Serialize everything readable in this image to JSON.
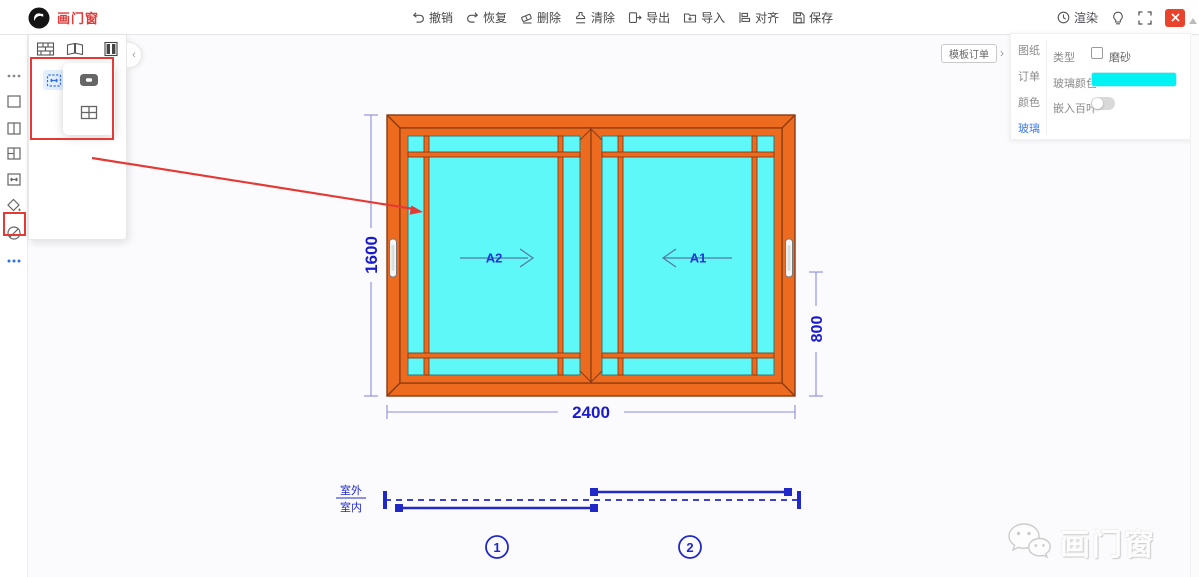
{
  "app": {
    "name": "画门窗",
    "brand_color": "#e03a3a"
  },
  "topbar": {
    "actions": [
      {
        "name": "undo",
        "label": "撤销"
      },
      {
        "name": "redo",
        "label": "恢复"
      },
      {
        "name": "delete",
        "label": "删除"
      },
      {
        "name": "clear",
        "label": "清除"
      },
      {
        "name": "export",
        "label": "导出"
      },
      {
        "name": "import",
        "label": "导入"
      },
      {
        "name": "align",
        "label": "对齐"
      },
      {
        "name": "save",
        "label": "保存"
      }
    ],
    "render_label": "渲染",
    "right_icons": [
      "render-clock-icon",
      "bulb-icon",
      "fullscreen-icon",
      "close-button"
    ]
  },
  "left_toolbar": {
    "icons": [
      "more-tools",
      "rect-window",
      "two-pane-window",
      "split-pane-window",
      "sliding-window-tool",
      "fill-color",
      "disabled-tool",
      "more-options"
    ]
  },
  "flyout": {
    "top_icons": [
      "wall-grid-icon",
      "open-window-icon",
      "filled-window-icon"
    ],
    "collapse_glyph": "‹",
    "selected_tool": "sliding-window-tool",
    "popup_icons": [
      "single-slider-icon",
      "grid-window-icon"
    ]
  },
  "right_panel": {
    "template_order_label": "模板订单",
    "collapse_glyph": "›",
    "tabs": [
      {
        "label": "图纸"
      },
      {
        "label": "订单"
      },
      {
        "label": "颜色"
      },
      {
        "label": "玻璃"
      }
    ],
    "active_tab": "玻璃",
    "fields": {
      "type_label": "类型",
      "frosted_label": "磨砂",
      "frosted_checked": false,
      "glass_color_label": "玻璃颜色",
      "glass_color_value": "#00f2f2",
      "blinds_label": "嵌入百叶",
      "blinds_on": false
    }
  },
  "drawing": {
    "dim_width": "2400",
    "dim_height": "1600",
    "dim_sub_height": "800",
    "sash_left_label": "A2",
    "sash_right_label": "A1",
    "outdoor_label": "室外",
    "indoor_label": "室内",
    "track_slot_1": "1",
    "track_slot_2": "2",
    "colors": {
      "frame": "#ED6B1F",
      "frame_border": "#8a3a12",
      "glass": "#5FF8F8",
      "dimension_text": "#1a1acd",
      "dimension_line": "#8d8de0",
      "diagram_blue": "#2128c8",
      "annotation_red": "#e43a35"
    }
  },
  "watermark": {
    "text": "画门窗"
  }
}
